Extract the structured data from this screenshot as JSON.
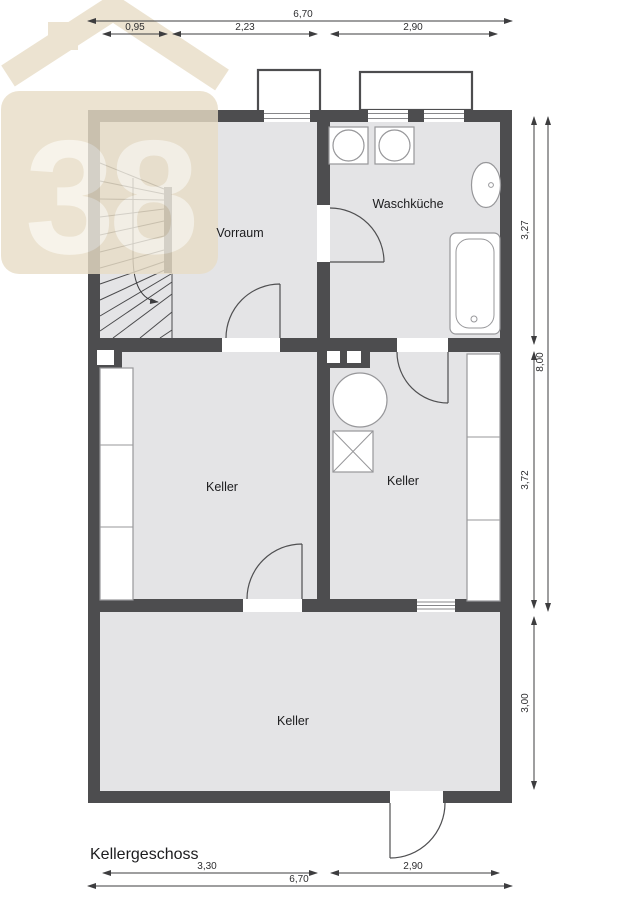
{
  "title": "Kellergeschoss",
  "watermark": {
    "number": "38"
  },
  "rooms": {
    "vorraum": "Vorraum",
    "waschkueche": "Waschküche",
    "keller_left": "Keller",
    "keller_right": "Keller",
    "keller_bottom": "Keller"
  },
  "dimensions": {
    "top_total": "6,70",
    "top_seg1": "0,95",
    "top_seg2": "2,23",
    "top_seg3": "2,90",
    "right_seg1": "3,27",
    "right_seg2": "3,72",
    "right_seg3": "3,00",
    "right_total": "8,00",
    "bottom_seg1": "3,30",
    "bottom_seg2": "2,90",
    "bottom_total": "6,70"
  },
  "colors": {
    "wall": "#4d4d4f",
    "floor": "#e4e4e6",
    "fixture_stroke": "#97979a",
    "dimension": "#3d3d3f",
    "watermark_beige": "#e8ddc6",
    "watermark_text": "#f6f1e5"
  }
}
